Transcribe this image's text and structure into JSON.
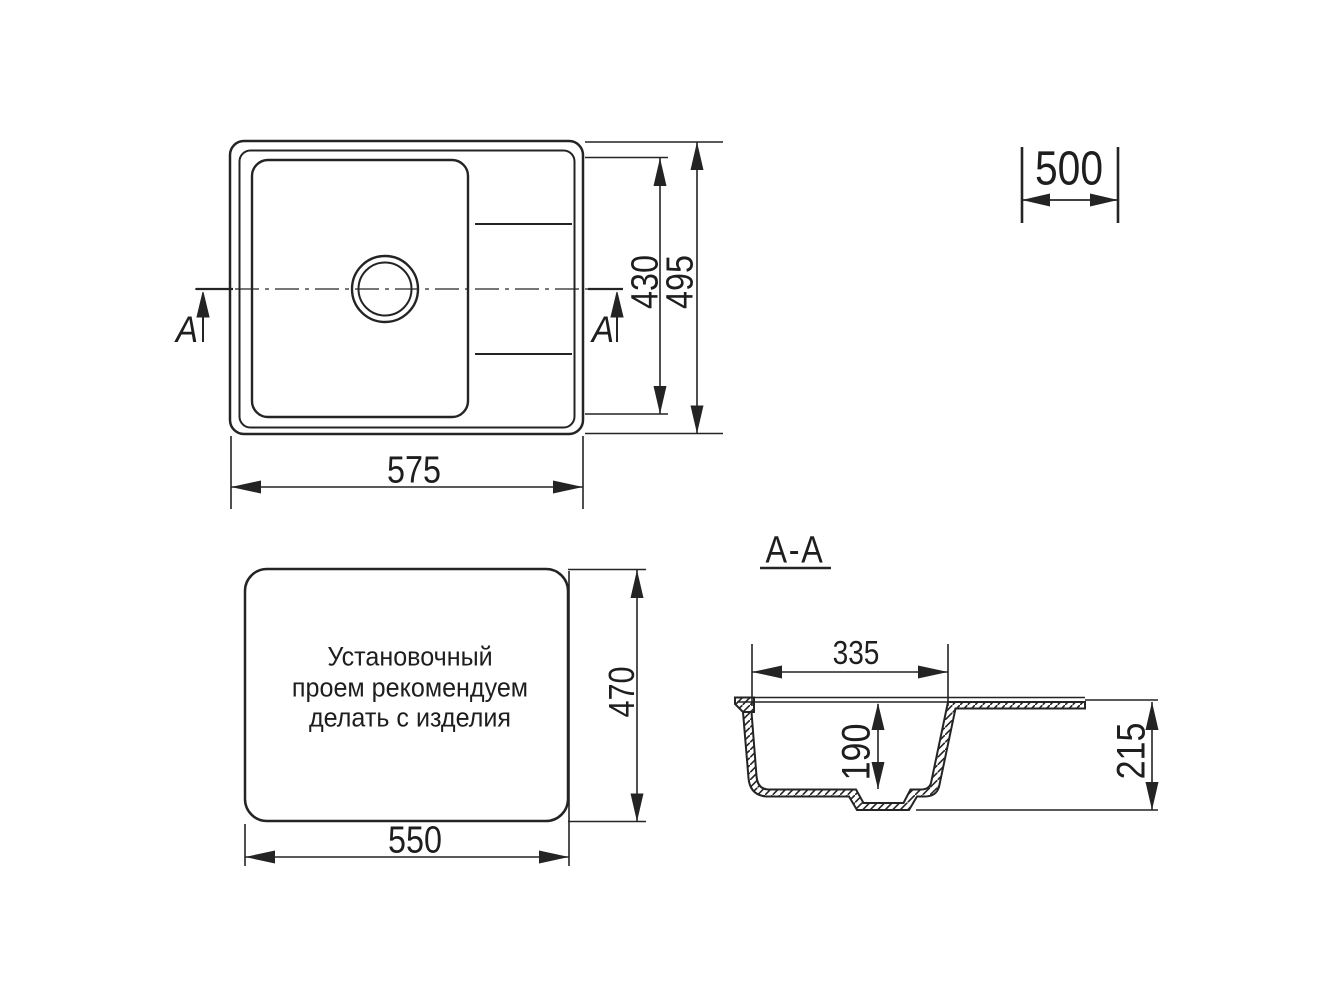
{
  "drawing": {
    "section_title": "A-A",
    "cut_marks": {
      "left": "A",
      "right": "A"
    },
    "dimensions": {
      "top_view_width": "575",
      "top_view_bowl_height": "430",
      "top_view_overall_height": "495",
      "cabinet_width": "500",
      "install_width": "550",
      "install_height": "470",
      "section_bowl_width": "335",
      "section_bowl_depth": "190",
      "section_overall_depth": "215"
    },
    "note": {
      "line1": "Установочный",
      "line2": "проем рекомендуем",
      "line3": "делать с изделия"
    },
    "colors": {
      "line": "#242424",
      "background": "#ffffff"
    }
  }
}
